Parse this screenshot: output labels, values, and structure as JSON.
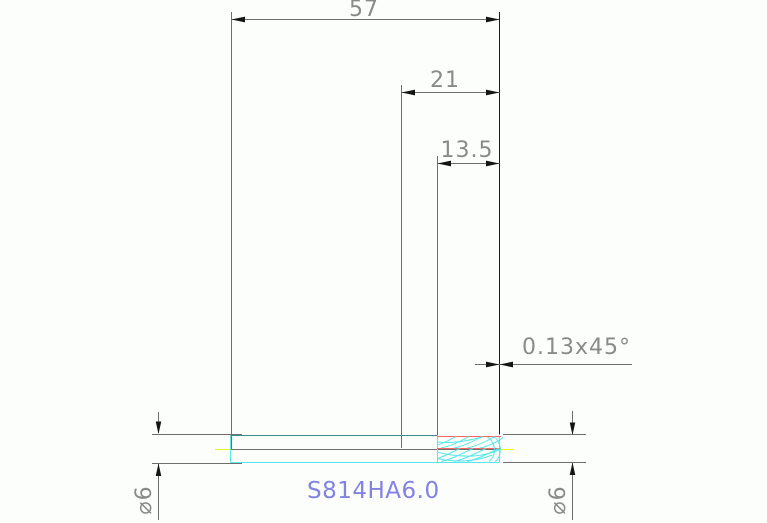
{
  "drawing": {
    "part_label": "S814HA6.0",
    "dimensions": {
      "overall_length": "57",
      "upper_section_length": "21",
      "flute_length": "13.5",
      "chamfer": "0.13x45°",
      "diameter_left": "⌀6",
      "diameter_right": "⌀6"
    },
    "colors": {
      "dimension_gray": "#6b6b6b",
      "text_gray": "#8a8a8a",
      "arrow_black": "#151515",
      "part_cyan": "#58e8e8",
      "part_teal": "#3c8e8e",
      "core_red": "#ff6262",
      "centerline_yellow": "#f2f21a",
      "label_blue": "#8282e2",
      "background": "#fcfefc"
    }
  }
}
